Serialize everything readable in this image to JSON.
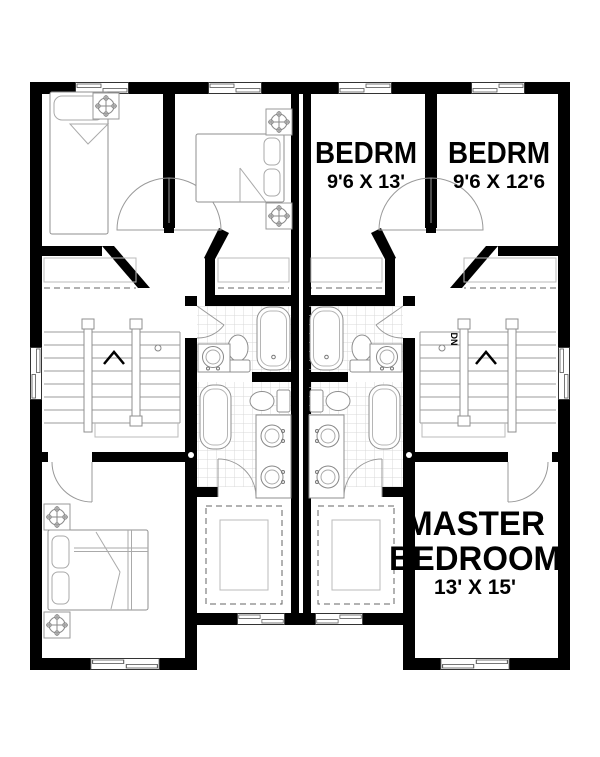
{
  "floor_plan": {
    "type": "duplex-upper-floor-plan",
    "rooms": {
      "bedroom_inner": {
        "label": "BEDRM",
        "dimensions": "9'6 X 13'"
      },
      "bedroom_outer": {
        "label": "BEDRM",
        "dimensions": "9'6 X 12'6"
      },
      "master_bedroom": {
        "label_line1": "MASTER",
        "label_line2": "BEDROOM",
        "dimensions": "13' X 15'"
      }
    },
    "stairs": {
      "direction_label": "DN"
    },
    "colors": {
      "walls": "#000000",
      "background": "#ffffff",
      "fixture_outline": "#9b9b9b",
      "tile_grid": "#d9d9d9",
      "closet_dash": "#666666",
      "text": "#000000"
    }
  }
}
